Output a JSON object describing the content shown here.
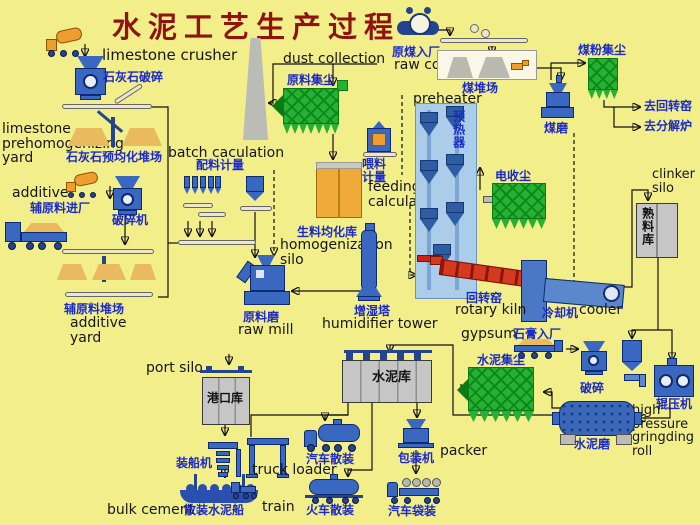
{
  "title": "水泥工艺生产过程",
  "labels": {
    "limestone_crusher_en": "limestone crusher",
    "limestone_crusher_zh": "石灰石破碎",
    "limestone_yard_en": "limestone prehomogenizing yard",
    "limestone_yard_zh": "石灰石预均化堆场",
    "batch_en": "batch caculation",
    "batch_zh": "配料计量",
    "additive_en": "additive",
    "additive_in_zh": "辅原料进厂",
    "additive_crusher_zh": "破碎机",
    "additive_yard_zh": "辅原料堆场",
    "additive_yard_en": "additive yard",
    "dust_collection_en": "dust collection",
    "raw_meal_dust_zh": "原料集尘",
    "feed_meter_zh": "喂料计量",
    "feeding_calc_en": "feeding calculation",
    "homog_silo_zh": "生料均化库",
    "homog_silo_en": "homogenization silo",
    "raw_mill_zh": "原料磨",
    "raw_mill_en": "raw mill",
    "humidifier_zh": "增湿塔",
    "humidifier_en": "humidifier tower",
    "preheater_en": "preheater",
    "preheater_zh": "预热器",
    "raw_coal_zh": "原煤入厂",
    "raw_coal_en": "raw coal",
    "coal_yard_zh": "煤堆场",
    "coal_mill_zh": "煤磨",
    "coal_dust_zh": "煤粉集尘",
    "to_rotary_kiln_zh": "去回转窑",
    "to_calciner_zh": "去分解炉",
    "ep_dust_zh": "电收尘",
    "clinker_silo_en": "clinker silo",
    "clinker_silo_zh": "熟料库",
    "rotary_kiln_zh": "回转窑",
    "rotary_kiln_en": "rotary kiln",
    "cooler_zh": "冷却机",
    "cooler_en": "cooler",
    "gypsum_en": "gypsum",
    "gypsum_zh": "石膏入厂",
    "cement_dust_zh": "水泥集尘",
    "cement_crusher_zh": "破碎",
    "roller_press_zh": "辊压机",
    "hp_roll_en": "high pressure gringding roll",
    "cement_mill_zh": "水泥磨",
    "cement_silo_zh": "水泥库",
    "port_silo_en": "port silo",
    "port_silo_zh": "港口库",
    "ship_loader_zh": "装船机",
    "bulk_cement_en": "bulk cement",
    "bulk_ship_zh": "散装水泥船",
    "truck_loader_en": "truck loader",
    "truck_bulk_zh": "汽车散装",
    "train_en": "train",
    "train_bulk_zh": "火车散装",
    "packer_zh": "包装机",
    "packer_en": "packer",
    "truck_bag_zh": "汽车袋装"
  },
  "colors": {
    "background": "#f2ee8a",
    "title_red": "#8e1313",
    "label_blue": "#1a2acc",
    "machine_blue": "#3a67c0",
    "preheater_light_blue": "#accdea",
    "collector_green": "#27b033",
    "kiln_red": "#d43a1f",
    "silo_gray": "#c6c6c6",
    "homog_silo_orange": "#efaa3a",
    "pile_tan": "#e9ba5e"
  }
}
